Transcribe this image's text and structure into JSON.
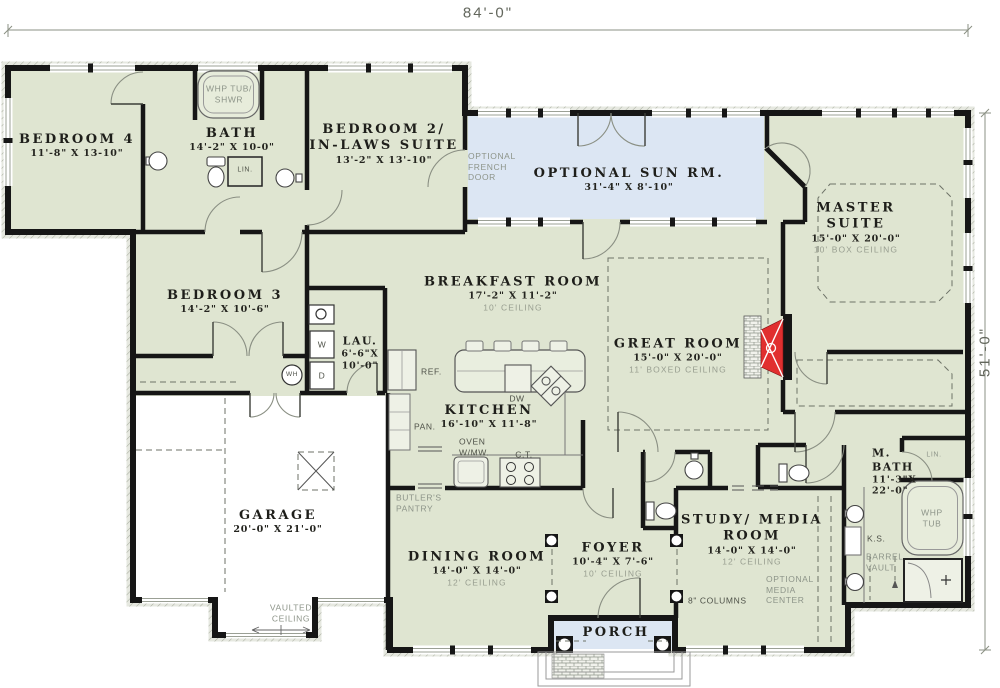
{
  "plan_title": "First floor plan",
  "dimensions": {
    "width": "84'-0\"",
    "depth": "51'-0\""
  },
  "colors": {
    "room_fill": "#dfe5d1",
    "sun_room_fill": "#dce6f3",
    "porch_fill": "#dce6f3",
    "wall": "#161616",
    "fireplace_red": "#e12f2f",
    "annotation_gray": "#8d9489"
  },
  "rooms": {
    "bedroom4": {
      "name": "BEDROOM 4",
      "dims": "11'-8\" X 13-10\""
    },
    "bath": {
      "name": "BATH",
      "dims": "14'-2\" X 10-0\""
    },
    "bedroom2": {
      "name": "BEDROOM 2/",
      "name2": "IN-LAWS SUITE",
      "dims": "13'-2\" X 13'-10\""
    },
    "sunroom": {
      "name": "OPTIONAL SUN RM.",
      "dims": "31'-4\" X 8'-10\""
    },
    "master": {
      "name": "MASTER",
      "name2": "SUITE",
      "dims": "15'-0\" X 20'-0\"",
      "ceiling": "10' BOX CEILING"
    },
    "bedroom3": {
      "name": "BEDROOM 3",
      "dims": "14'-2\" X 10'-6\""
    },
    "breakfast": {
      "name": "BREAKFAST ROOM",
      "dims": "17'-2\" X 11'-2\"",
      "ceiling": "10' CEILING"
    },
    "great": {
      "name": "GREAT ROOM",
      "dims": "15'-0\" X 20'-0\"",
      "ceiling": "11' BOXED CEILING"
    },
    "laundry": {
      "name": "LAU.",
      "dims": "6'-6\"X",
      "dims2": "10'-0\""
    },
    "kitchen": {
      "name": "KITCHEN",
      "dims": "16'-10\" X 11'-8\""
    },
    "garage": {
      "name": "GARAGE",
      "dims": "20'-0\" X 21'-0\""
    },
    "dining": {
      "name": "DINING ROOM",
      "dims": "14'-0\" X 14'-0\"",
      "ceiling": "12' CEILING"
    },
    "foyer": {
      "name": "FOYER",
      "dims": "10'-4\" X 7'-6\"",
      "ceiling": "10' CEILING"
    },
    "study": {
      "name": "STUDY/ MEDIA",
      "name2": "ROOM",
      "dims": "14'-0\" X 14'-0\"",
      "ceiling": "12' CEILING"
    },
    "mbath": {
      "name": "M.",
      "name2": "BATH",
      "dims": "11'-3\"X",
      "dims2": "22'-0\""
    },
    "porch": {
      "name": "PORCH"
    }
  },
  "annotations": {
    "whp_tub_1": "WHP TUB/",
    "whp_tub_2": "SHWR",
    "lin_bath": "LIN.",
    "french_1": "OPTIONAL",
    "french_2": "FRENCH",
    "french_3": "DOOR",
    "ref": "REF.",
    "pan": "PAN.",
    "dw": "DW",
    "oven_1": "OVEN",
    "oven_2": "W/MW.",
    "ct": "C.T.",
    "butlers_1": "BUTLER'S",
    "butlers_2": "PANTRY",
    "wh": "WH",
    "w": "W",
    "d": "D",
    "columns": "8\" COLUMNS",
    "media_1": "OPTIONAL",
    "media_2": "MEDIA",
    "media_3": "CENTER",
    "lin_mbath": "LIN.",
    "ks": "K.S.",
    "barrel_1": "BARREL",
    "barrel_2": "VAULT",
    "whp_tub2_1": "WHP",
    "whp_tub2_2": "TUB",
    "vaulted_1": "VAULTED",
    "vaulted_2": "CEILING"
  }
}
